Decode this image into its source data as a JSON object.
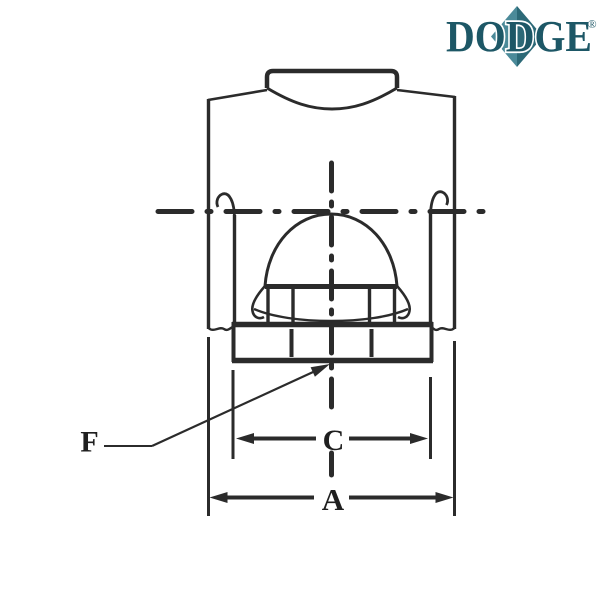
{
  "logo": {
    "text": "DODGE",
    "registered_mark": "®",
    "letter_color": "#1d5766",
    "diamond_left_color": "#4b8a99",
    "diamond_right_color": "#2c6977"
  },
  "drawing": {
    "line_color": "#2b2b2b",
    "label_color": "#1f1f1f",
    "labels": {
      "overall_width": "A",
      "base_width": "C",
      "leader": "F"
    }
  }
}
